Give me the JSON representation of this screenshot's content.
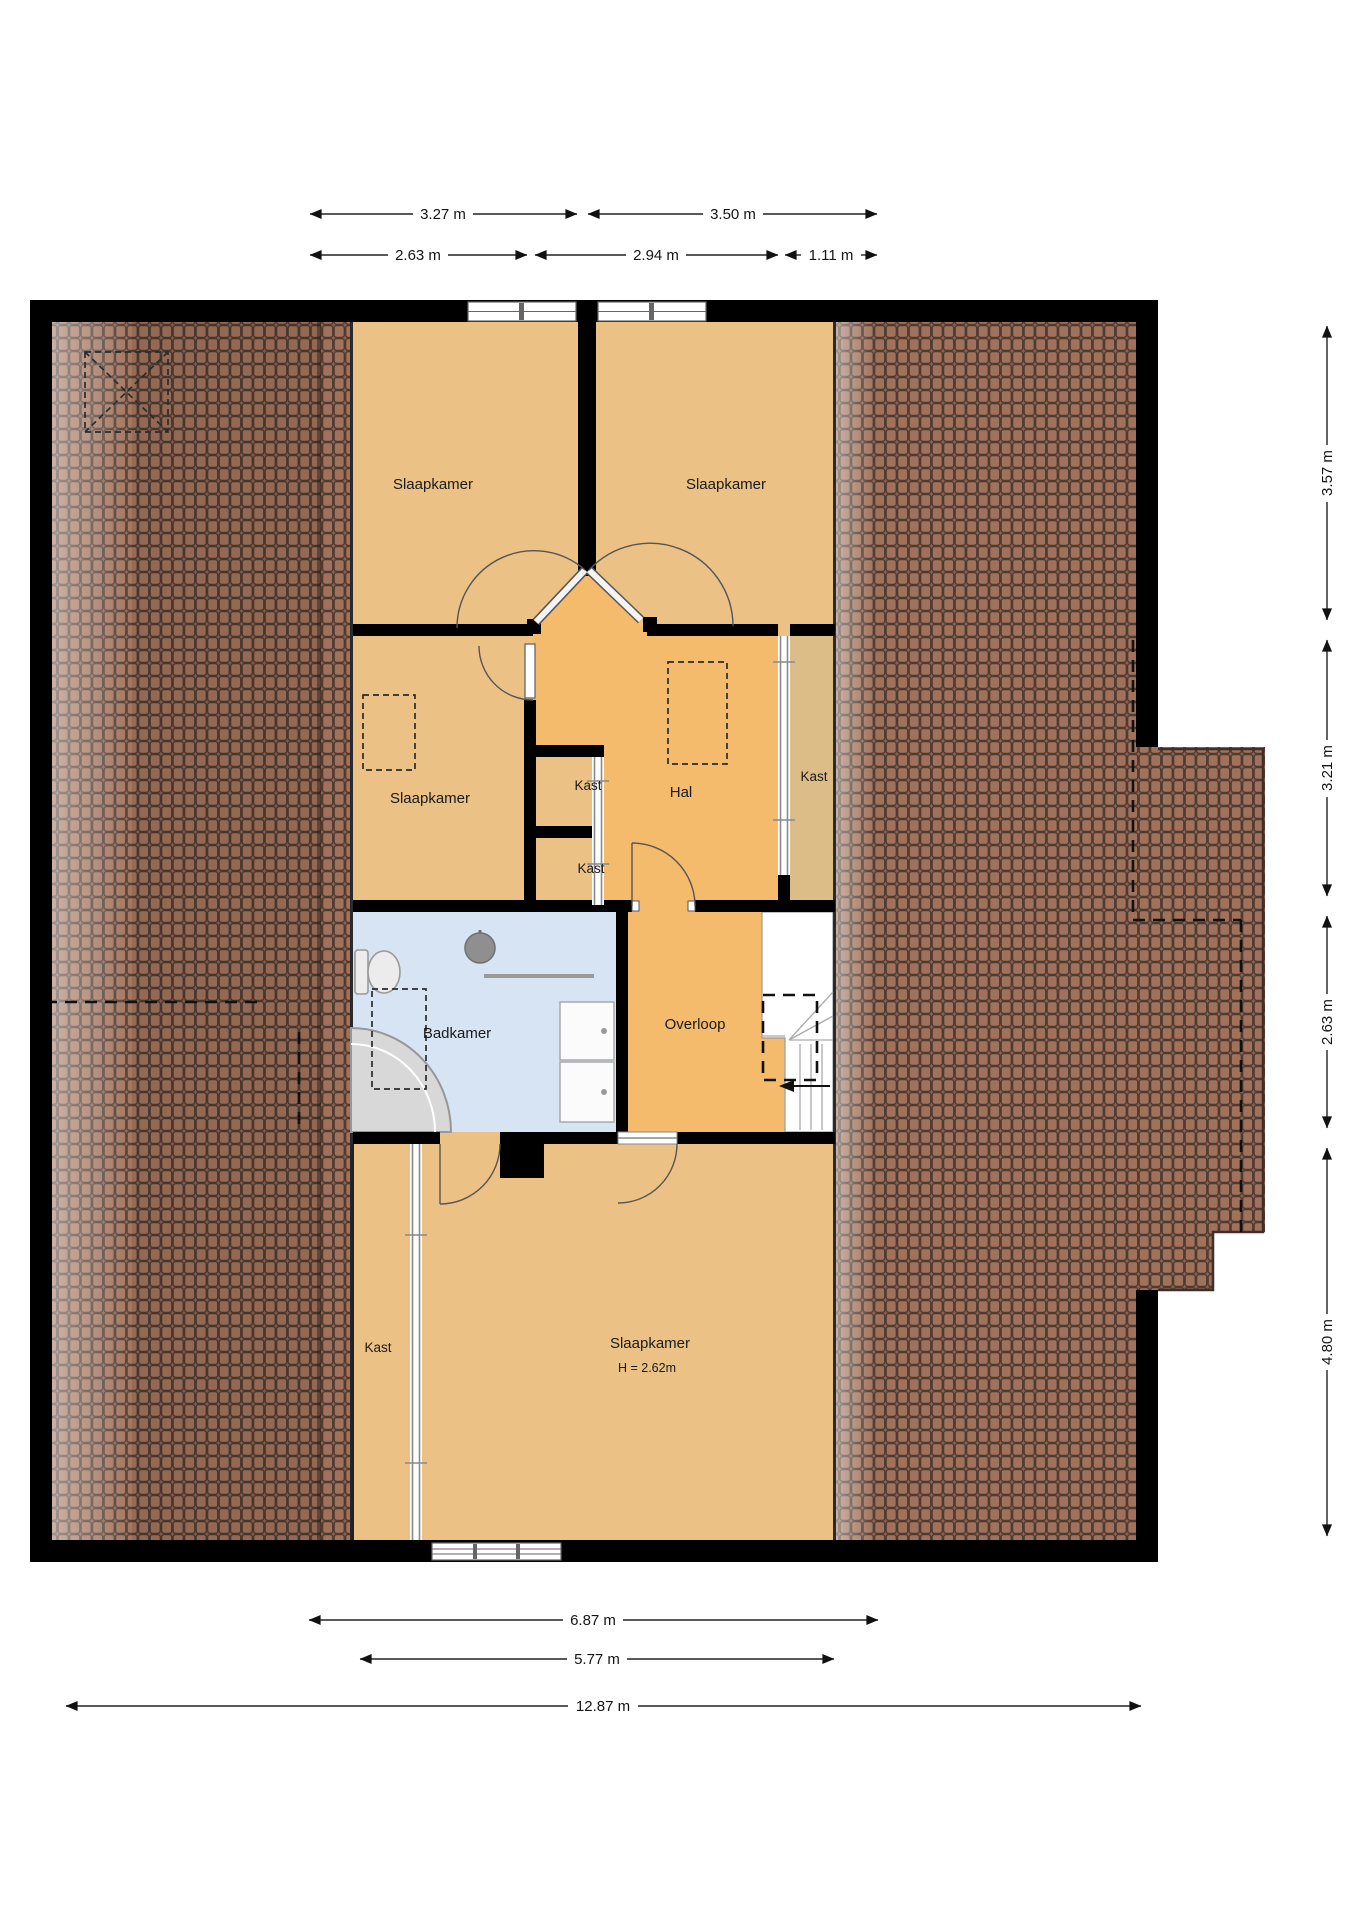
{
  "plan": {
    "rooms": {
      "bedroom_top_left": {
        "label": "Slaapkamer"
      },
      "bedroom_top_right": {
        "label": "Slaapkamer"
      },
      "bedroom_middle": {
        "label": "Slaapkamer"
      },
      "closet_upper": {
        "label": "Kast"
      },
      "closet_lower": {
        "label": "Kast"
      },
      "hall": {
        "label": "Hal"
      },
      "closet_right": {
        "label": "Kast"
      },
      "bathroom": {
        "label": "Badkamer"
      },
      "landing": {
        "label": "Overloop"
      },
      "closet_bottom": {
        "label": "Kast"
      },
      "bedroom_bottom": {
        "label": "Slaapkamer",
        "height_note": "H = 2.62m"
      }
    },
    "dimensions": {
      "top_row_1": [
        {
          "label": "3.27 m"
        },
        {
          "label": "3.50 m"
        }
      ],
      "top_row_2": [
        {
          "label": "2.63 m"
        },
        {
          "label": "2.94 m"
        },
        {
          "label": "1.11 m"
        }
      ],
      "right_column": [
        {
          "label": "3.57 m"
        },
        {
          "label": "3.21 m"
        },
        {
          "label": "2.63 m"
        },
        {
          "label": "4.80 m"
        }
      ],
      "bottom_rows": [
        {
          "label": "6.87 m"
        },
        {
          "label": "5.77 m"
        },
        {
          "label": "12.87 m"
        }
      ]
    },
    "colors": {
      "wall": "#000000",
      "room_fill": "#ebc185",
      "hall_fill": "#f4bb6c",
      "closet_right_fill": "#ddbd87",
      "bathroom_fill": "#d6e4f4",
      "stairs_fill": "#ffffff",
      "roof_base": "#8a6150",
      "roof_tile": "#a1725b",
      "roof_tile_line": "#4d3a31"
    }
  }
}
